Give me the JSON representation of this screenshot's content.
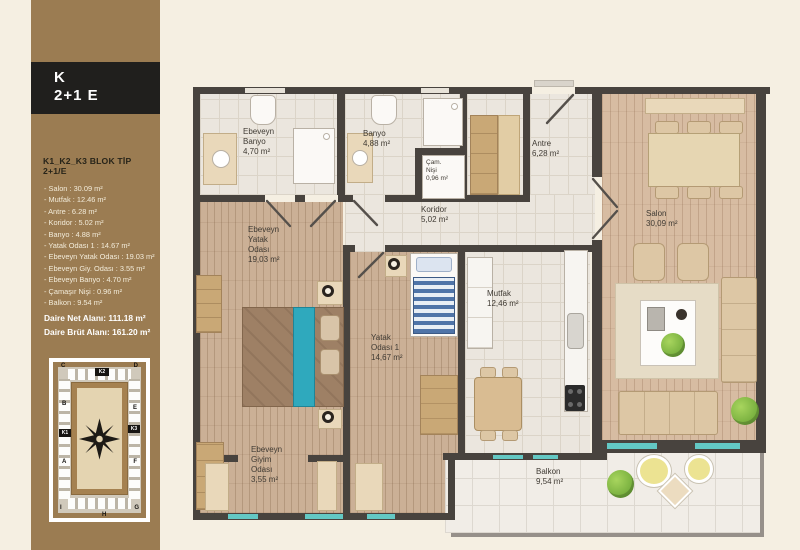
{
  "sidebar": {
    "header": {
      "line1": "K",
      "line2": "2+1 E"
    },
    "block_title": "K1_K2_K3 BLOK TİP 2+1/E",
    "items": [
      "- Salon : 30.09 m²",
      "- Mutfak : 12.46 m²",
      "- Antre : 6.28 m²",
      "- Koridor : 5.02 m²",
      "- Banyo : 4.88 m²",
      "- Yatak Odası 1 : 14.67 m²",
      "- Ebeveyn Yatak Odası : 19.03 m²",
      "- Ebeveyn Giy. Odası : 3.55 m²",
      "- Ebeveyn Banyo : 4.70 m²",
      "- Çamaşır Nişi : 0.96 m²",
      "- Balkon : 9.54 m²"
    ],
    "net_area": "Daire Net Alanı: 111.18 m²",
    "brut_area": "Daire Brüt Alanı: 161.20 m²",
    "siteplan": {
      "b_c": "C",
      "b_d": "D",
      "b_b": "B",
      "b_e": "E",
      "b_a": "A",
      "b_f": "F",
      "b_i": "I",
      "b_h": "H",
      "b_g": "G",
      "k1": "K1",
      "k2": "K2",
      "k3": "K3"
    }
  },
  "plan": {
    "ebeveyn_banyo": {
      "l1": "Ebeveyn",
      "l2": "Banyo",
      "l3": "4,70 m²"
    },
    "banyo": {
      "l1": "Banyo",
      "l2": "4,88 m²"
    },
    "cam_nisi": {
      "l1": "Çam.",
      "l2": "Nişi",
      "l3": "0,96 m²"
    },
    "antre": {
      "l1": "Antre",
      "l2": "6,28 m²"
    },
    "koridor": {
      "l1": "Koridor",
      "l2": "5,02 m²"
    },
    "ebeveyn_yatak": {
      "l1": "Ebeveyn",
      "l2": "Yatak",
      "l3": "Odası",
      "l4": "19,03 m²"
    },
    "yatak_1": {
      "l1": "Yatak",
      "l2": "Odası 1",
      "l3": "14,67 m²"
    },
    "mutfak": {
      "l1": "Mutfak",
      "l2": "12,46 m²"
    },
    "salon": {
      "l1": "Salon",
      "l2": "30,09 m²"
    },
    "giyim": {
      "l1": "Ebeveyn",
      "l2": "Giyim",
      "l3": "Odası",
      "l4": "3,55 m²"
    },
    "balkon": {
      "l1": "Balkon",
      "l2": "9,54 m²"
    }
  },
  "colors": {
    "sidebar_brown": "#9b7c52",
    "band_black": "#201f1d",
    "background_cream": "#f5efe2",
    "wall_dark": "#48433e",
    "glass_teal": "#63c8c4",
    "wood_floor": "#cbb096",
    "salon_floor": "#d7bca2",
    "tile_floor": "#ebe6de"
  }
}
